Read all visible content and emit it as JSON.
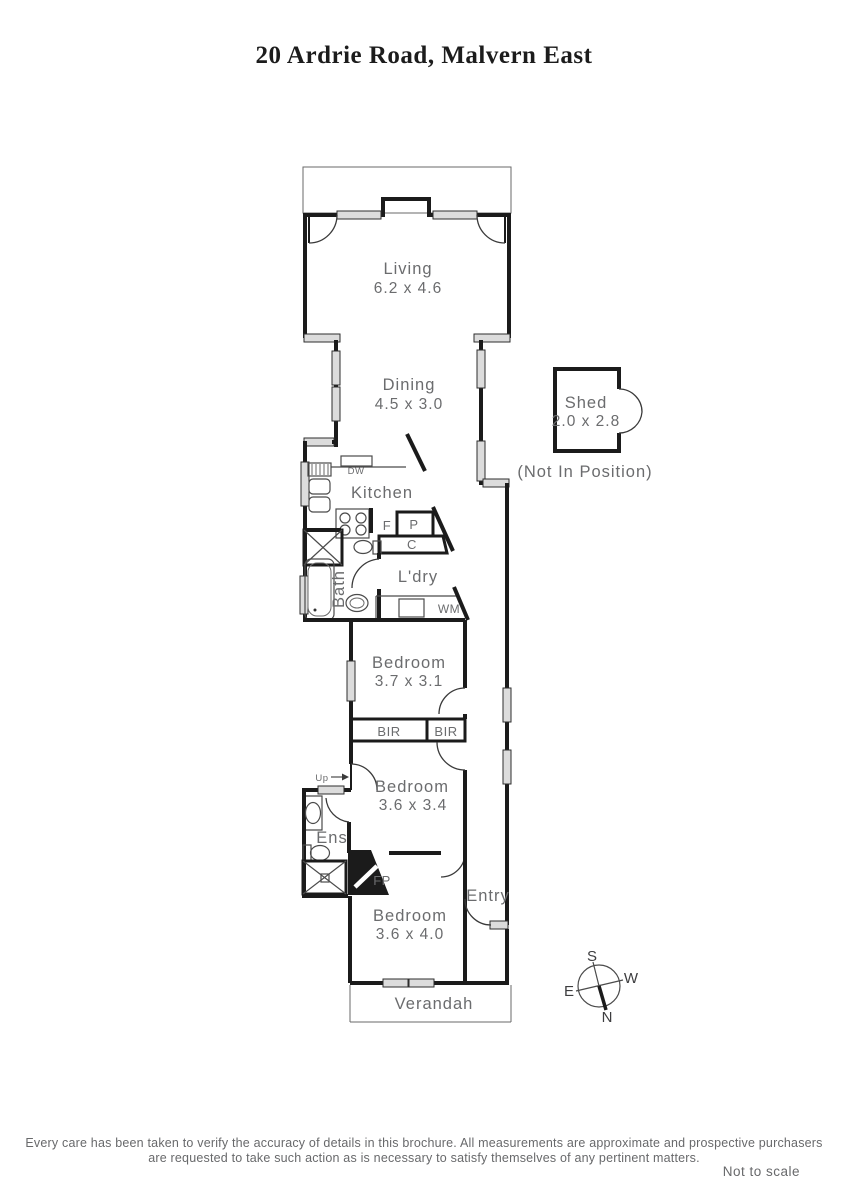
{
  "title": "20 Ardrie Road, Malvern East",
  "rooms": {
    "living": {
      "name": "Living",
      "dims": "6.2 x 4.6"
    },
    "dining": {
      "name": "Dining",
      "dims": "4.5 x 3.0"
    },
    "kitchen": {
      "name": "Kitchen"
    },
    "bath": {
      "name": "Bath"
    },
    "laundry": {
      "name": "L'dry"
    },
    "bedroom1": {
      "name": "Bedroom",
      "dims": "3.7 x 3.1"
    },
    "bedroom2": {
      "name": "Bedroom",
      "dims": "3.6 x 3.4"
    },
    "bedroom3": {
      "name": "Bedroom",
      "dims": "3.6 x 4.0"
    },
    "ensuite": {
      "name": "Ens"
    },
    "entry": {
      "name": "Entry"
    },
    "verandah": {
      "name": "Verandah"
    },
    "shed": {
      "name": "Shed",
      "dims": "2.0 x 2.8",
      "note": "(Not In Position)"
    }
  },
  "fixtures": {
    "dishwasher": "DW",
    "washing_machine": "WM",
    "fridge": "F",
    "pantry": "P",
    "cupboard": "C",
    "built_in_robe_1": "BIR",
    "built_in_robe_2": "BIR",
    "fireplace": "FP",
    "stairs": "Up"
  },
  "compass": {
    "north": "N",
    "south": "S",
    "east": "E",
    "west": "W"
  },
  "footer": {
    "line1": "Every care has been taken to verify the accuracy of details in this brochure.  All measurements are approximate and prospective purchasers",
    "line2": "are requested to take such action as is necessary to satisfy themselves of any pertinent matters.",
    "scale_note": "Not to scale"
  },
  "colors": {
    "wall": "#1b1b1b",
    "label": "#6b6c6e",
    "window": "#dcdcdc"
  }
}
